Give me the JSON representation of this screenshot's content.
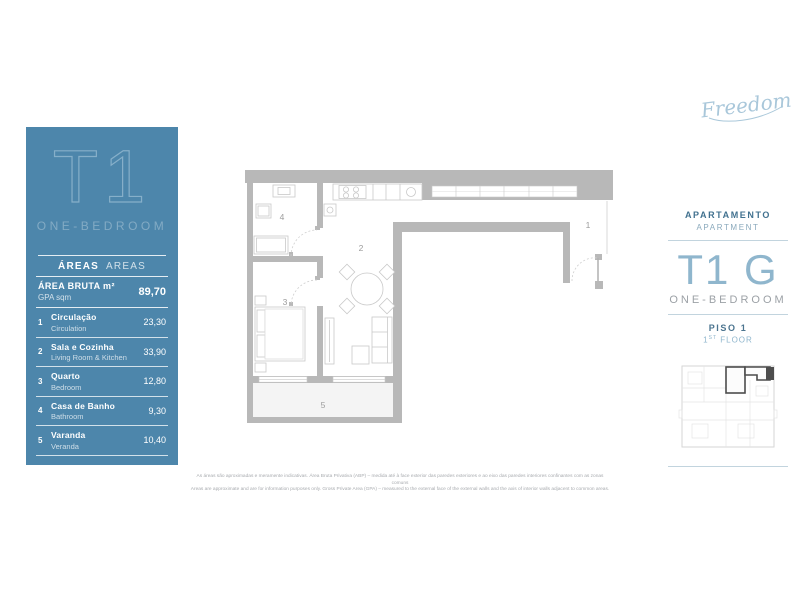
{
  "logo": {
    "text": "Freedom"
  },
  "sidebar": {
    "unit": "T1",
    "unit_type": "ONE-BEDROOM",
    "areas_pt": "ÁREAS",
    "areas_en": "AREAS",
    "gross": {
      "label_pt": "ÁREA BRUTA m²",
      "label_en": "GPA sqm",
      "value": "89,70"
    },
    "rows": [
      {
        "num": "1",
        "pt": "Circulação",
        "en": "Circulation",
        "value": "23,30"
      },
      {
        "num": "2",
        "pt": "Sala e Cozinha",
        "en": "Living Room & Kitchen",
        "value": "33,90"
      },
      {
        "num": "3",
        "pt": "Quarto",
        "en": "Bedroom",
        "value": "12,80"
      },
      {
        "num": "4",
        "pt": "Casa de Banho",
        "en": "Bathroom",
        "value": "9,30"
      },
      {
        "num": "5",
        "pt": "Varanda",
        "en": "Veranda",
        "value": "10,40"
      }
    ]
  },
  "plan": {
    "labels": {
      "r1": "1",
      "r2": "2",
      "r3": "3",
      "r4": "4",
      "r5": "5"
    }
  },
  "info": {
    "apartamento": "APARTAMENTO",
    "apartment": "APARTMENT",
    "unit": "T1 G",
    "unit_type": "ONE-BEDROOM",
    "piso": "PISO 1",
    "floor_num": "1",
    "floor_ord": "ST",
    "floor_word": "FLOOR"
  },
  "footer": {
    "pt": "As áreas são aproximadas e meramente indicativas. Área Bruta Privativa (ABP) – medida até à face exterior das paredes exteriores e ao eixo das paredes interiores confinantes com as zonas comuns",
    "en": "Areas are approximate and are for information purposes only. Gross Private Area (GPA) – measured to the external face of the external walls and the axis of interior walls adjacent to common areas."
  },
  "colors": {
    "sidebar_blue": "#4d86ab",
    "accent_light_blue": "#8fb6cd",
    "wall_gray": "#b8b8b8"
  }
}
